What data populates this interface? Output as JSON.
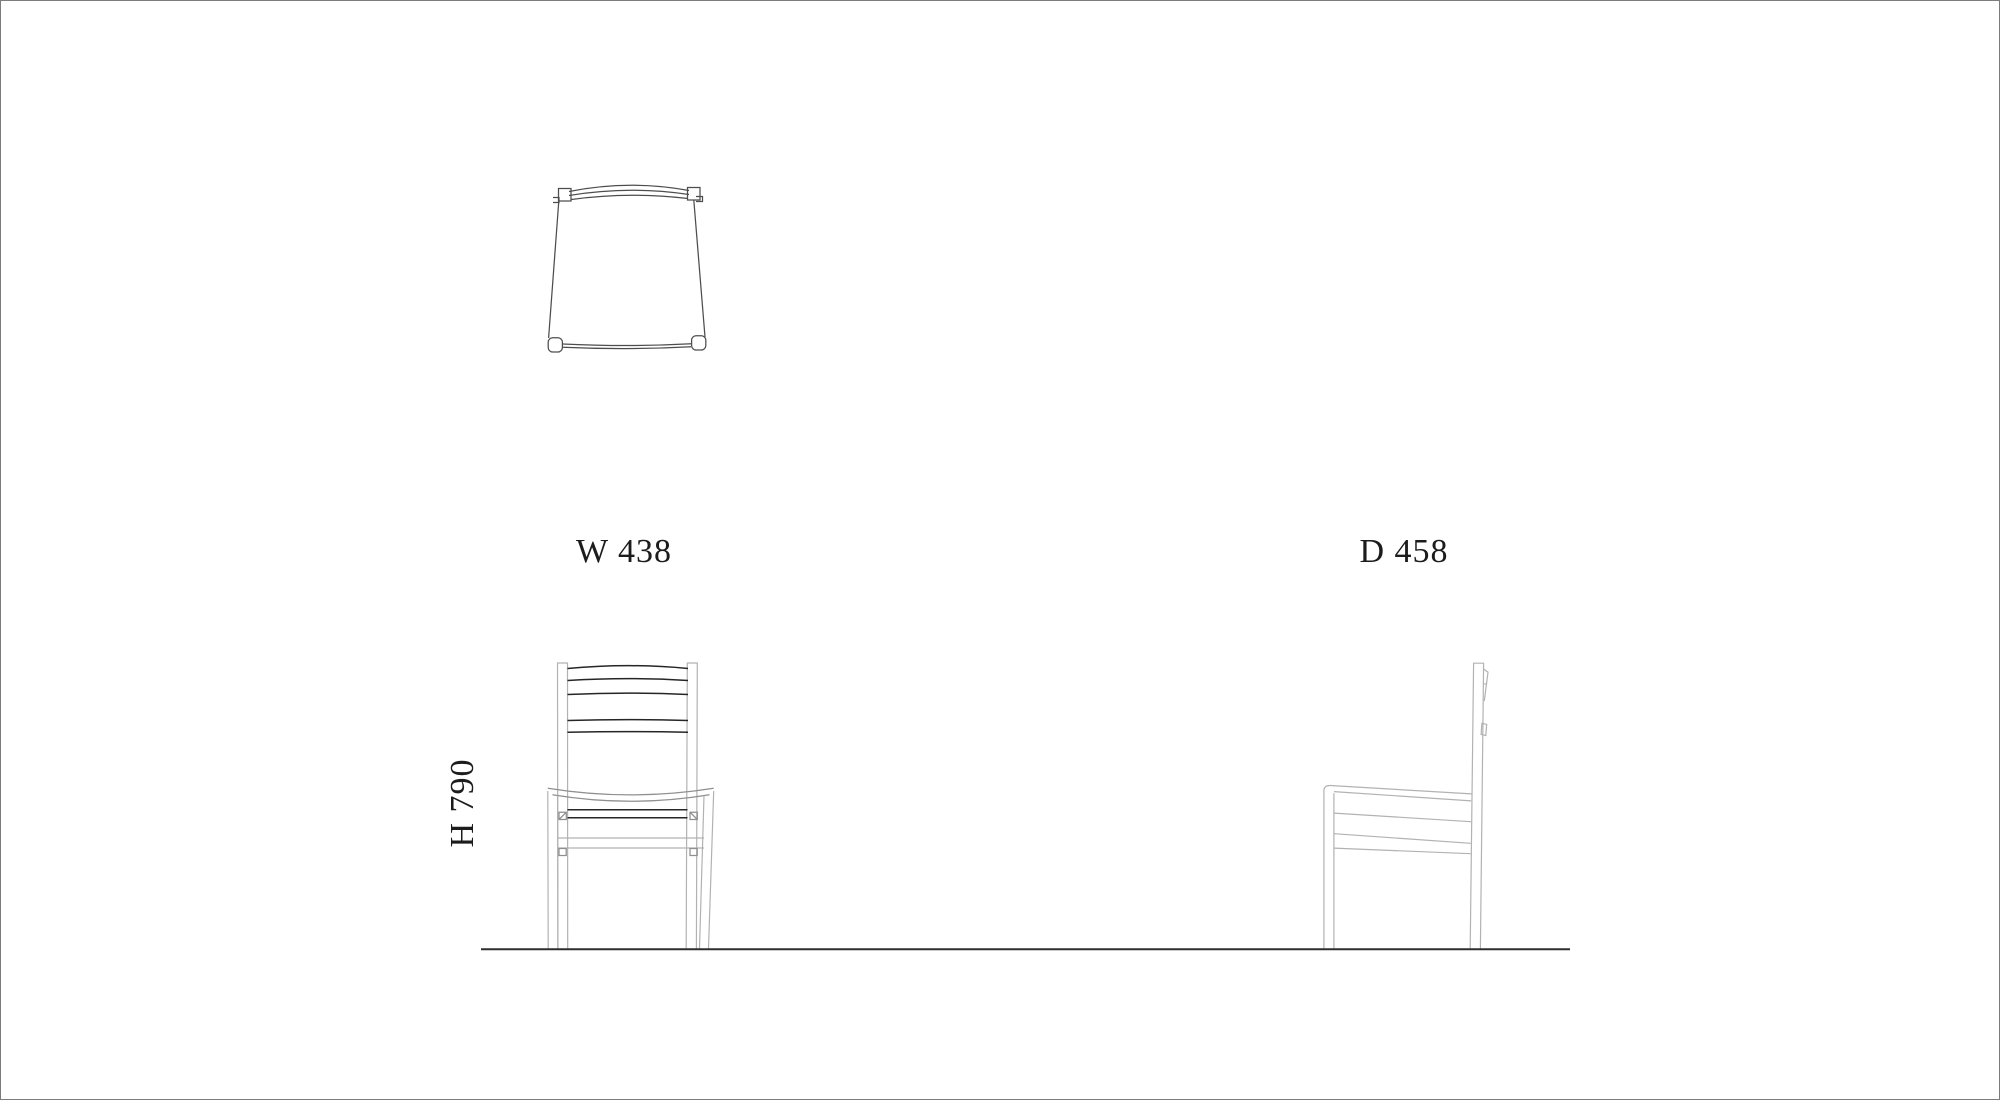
{
  "labels": {
    "width": "W 438",
    "depth": "D 458",
    "height": "H 790"
  },
  "dimensions_mm": {
    "width": 438,
    "depth": 458,
    "height": 790
  },
  "colors": {
    "background": "#ffffff",
    "border": "#7d7d7d",
    "line-light": "#b2b2b2",
    "line-mid": "#8f8f8f",
    "line-plan": "#4d4d4d",
    "line-dark": "#262626",
    "ground": "#2e2e2e",
    "text": "#1c1c1c"
  }
}
